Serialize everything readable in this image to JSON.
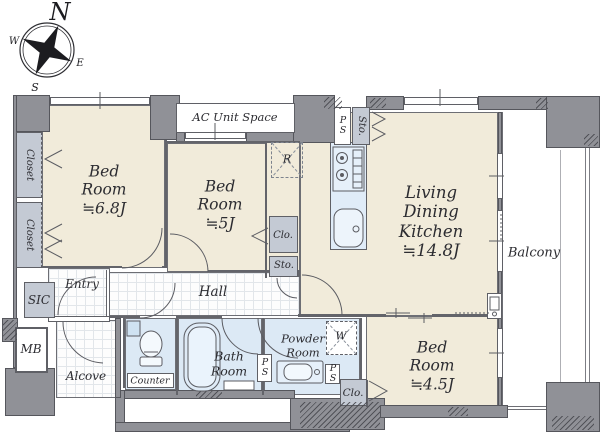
{
  "compass": {
    "north": "N",
    "east": "E",
    "south": "S",
    "west": "W"
  },
  "rooms": {
    "bedroom_main": {
      "name": "Bed Room",
      "size": "≒6.8J"
    },
    "bedroom_mid": {
      "name": "Bed Room",
      "size": "≒5J"
    },
    "ldk": {
      "name": "Living Dining Kitchen",
      "size": "≒14.8J"
    },
    "bedroom_small": {
      "name": "Bed Room",
      "size": "≒4.5J"
    },
    "balcony": {
      "name": "Balcony"
    },
    "hall": {
      "name": "Hall"
    },
    "entry": {
      "name": "Entry"
    },
    "alcove": {
      "name": "Alcove"
    },
    "bath": {
      "name": "Bath Room"
    },
    "powder": {
      "name": "Powder Room"
    }
  },
  "features": {
    "ac_unit_space": "AC Unit Space",
    "closet": "Closet",
    "closet_abbr": "Clo.",
    "storage_abbr": "Sto.",
    "pipe_space": "PS",
    "shoe_closet": "SIC",
    "meter_box": "MB",
    "counter": "Counter",
    "refrigerator_space": "R",
    "washer_space": "W"
  },
  "colors": {
    "floor": "#f1ebda",
    "wet_floor": "#dce9f5",
    "wall": "#909197",
    "storage": "#c4cad4",
    "line": "#5b5c62"
  }
}
